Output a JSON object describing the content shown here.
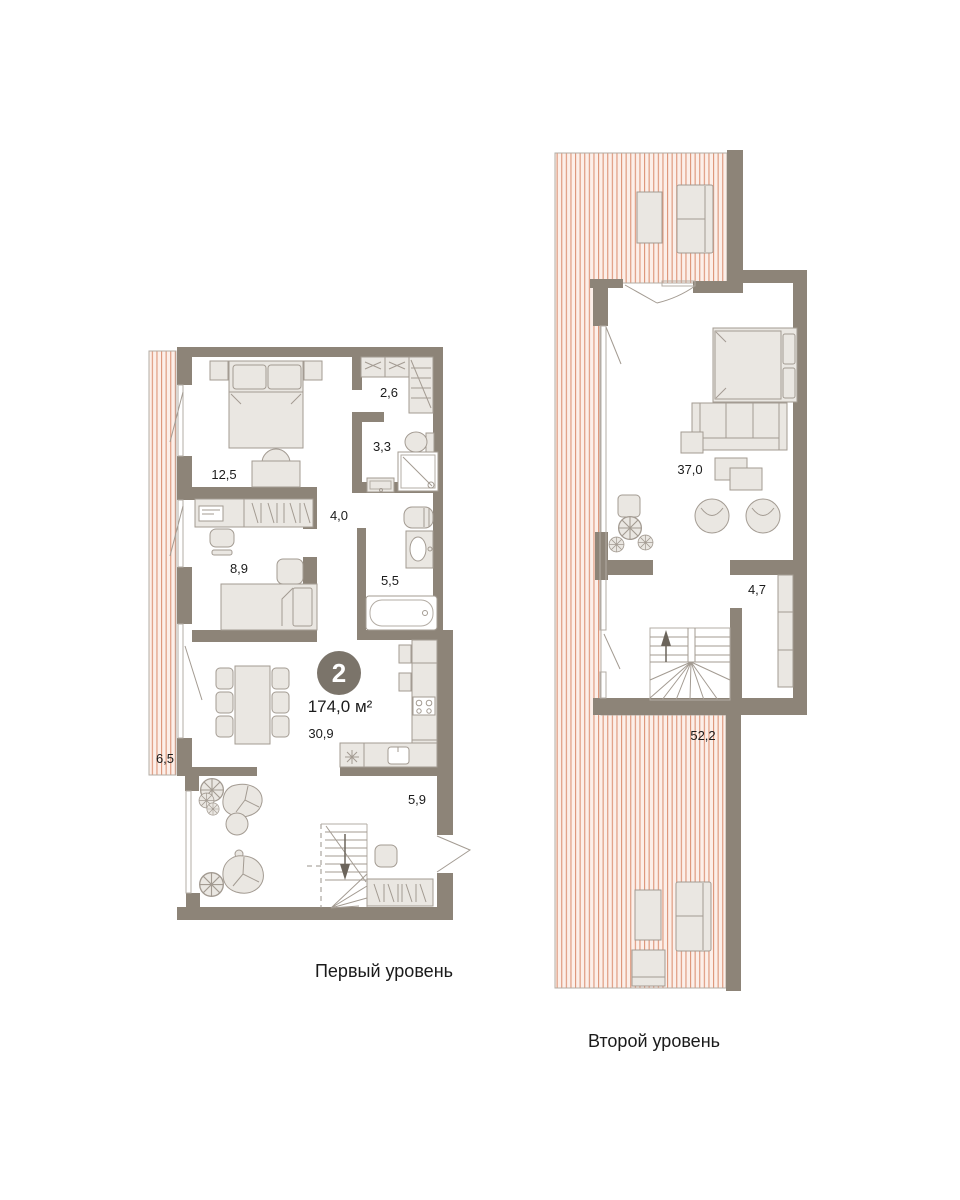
{
  "badge": {
    "number": "2",
    "area": "174,0 м²"
  },
  "level1": {
    "caption": "Первый уровень",
    "rooms": {
      "bedroom": "12,5",
      "wardrobe": "2,6",
      "bathroom_small": "3,3",
      "hall": "4,0",
      "bedroom_small": "8,9",
      "bathroom": "5,5",
      "living_kitchen": "30,9",
      "hallway": "5,9",
      "balcony": "6,5"
    }
  },
  "level2": {
    "caption": "Второй уровень",
    "rooms": {
      "living_room": "37,0",
      "wardrobe": "4,7",
      "terrace": "52,2"
    }
  },
  "colors": {
    "wall": "#8d8478",
    "furniture_fill": "#eae7e2",
    "furniture_stroke": "#a39b92",
    "hatch_line": "#dd9478",
    "hatch_bg": "#fcefe9",
    "terrace_outline": "#b3aca4",
    "text": "#1c1c1c",
    "badge_bg": "#7b746a"
  }
}
